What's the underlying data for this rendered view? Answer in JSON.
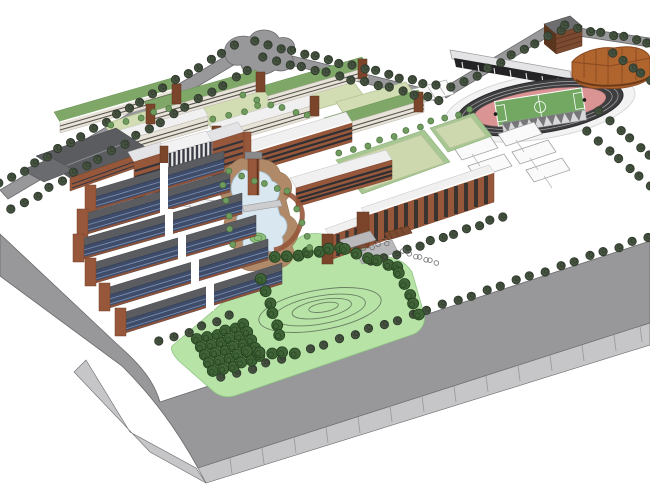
{
  "meta": {
    "kind": "3d-campus-masterplan-render",
    "style": "sketchup-aerial-perspective",
    "canvas": {
      "width": 650,
      "height": 487
    }
  },
  "colors": {
    "background": "#ffffff",
    "road": "#98989b",
    "road_face": "#c6c6c8",
    "road_edge": "#6a6a6c",
    "park": "#b7e3a6",
    "contour": "#6b7f63",
    "court_khaki": "#ced8af",
    "court_border": "#a6c792",
    "field_green": "#72a862",
    "track_pink": "#db9494",
    "track_ring": "#3e3e40",
    "stand_dark": "#232325",
    "canopy": "#d9d9db",
    "brick": "#96573b",
    "brick_dark": "#7a452b",
    "roof_green": "#7fa868",
    "roof_dark": "#5b5c60",
    "window_blue": "#3e4c6a",
    "pond": "#d9e7f1",
    "pond_edge": "#9fb9cc",
    "island": "#8cc07c",
    "path_brown": "#b08a68",
    "gym_roof": "#b0642e",
    "slat_brown": "#7c4a30",
    "gray_bldg": "#b9b9bb",
    "tree_dark": "#45523f",
    "tree_park": "#3f6336",
    "tree_small": "#6f9c5e"
  },
  "scene": {
    "description": "Aerial perspective rendering of a university campus master plan on a white background: perimeter roads with street trees, northwest academic quads with green roofs, central library and pond with clock tower, southwest dormitory rows with blue window grids, east dormitory slabs, running track with soccer field and grandstand, gymnasium with orange hipped roof, sports courts, and a landscaped park with contoured hill and tree groves beside a wide segmented boulevard.",
    "areas": [
      "academic quads",
      "library plaza",
      "central pond",
      "clock tower",
      "west dormitory rows",
      "east dormitories",
      "running track stadium",
      "grandstand",
      "gymnasium",
      "basketball courts",
      "sports fields",
      "landscaped park",
      "tree grove",
      "perimeter roads",
      "main boulevard",
      "entrance plaza",
      "parking lot",
      "bike racks"
    ],
    "tree_rows": [
      {
        "name": "perimeter-trees-nw-outer",
        "type": "road",
        "x1": 0,
        "y1": 184,
        "x2": 234,
        "y2": 46,
        "n": 21
      },
      {
        "name": "perimeter-trees-nw-inner",
        "type": "road",
        "x1": 12,
        "y1": 210,
        "x2": 248,
        "y2": 70,
        "n": 20
      },
      {
        "name": "north-road-trees-outer",
        "type": "road",
        "x1": 256,
        "y1": 42,
        "x2": 436,
        "y2": 86,
        "n": 16
      },
      {
        "name": "north-road-trees-inner",
        "type": "road",
        "x1": 264,
        "y1": 58,
        "x2": 440,
        "y2": 100,
        "n": 15
      },
      {
        "name": "stadium-north-trees",
        "type": "road",
        "x1": 452,
        "y1": 88,
        "x2": 560,
        "y2": 30,
        "n": 10
      },
      {
        "name": "northeast-corner-trees",
        "type": "road",
        "x1": 566,
        "y1": 26,
        "x2": 648,
        "y2": 42,
        "n": 8
      },
      {
        "name": "east-boundary-trees",
        "type": "road",
        "x1": 614,
        "y1": 54,
        "x2": 650,
        "y2": 80,
        "n": 5
      },
      {
        "name": "stadium-east-trees-1",
        "type": "road",
        "x1": 600,
        "y1": 112,
        "x2": 650,
        "y2": 156,
        "n": 6
      },
      {
        "name": "stadium-east-trees-2",
        "type": "road",
        "x1": 588,
        "y1": 132,
        "x2": 650,
        "y2": 186,
        "n": 7
      },
      {
        "name": "main-road-trees",
        "type": "road",
        "x1": 222,
        "y1": 378,
        "x2": 648,
        "y2": 237,
        "n": 30
      },
      {
        "name": "park-west-edge-trees",
        "type": "road",
        "x1": 160,
        "y1": 342,
        "x2": 230,
        "y2": 316,
        "n": 6
      },
      {
        "name": "dorm-east-walkway-trees",
        "type": "road",
        "x1": 372,
        "y1": 262,
        "x2": 502,
        "y2": 217,
        "n": 12
      },
      {
        "name": "bike-racks-east",
        "type": "bike",
        "x1": 404,
        "y1": 252,
        "x2": 436,
        "y2": 263,
        "n": 7
      },
      {
        "name": "bike-racks-center",
        "type": "bike",
        "x1": 356,
        "y1": 250,
        "x2": 386,
        "y2": 243,
        "n": 5
      },
      {
        "name": "park-grove-row-1",
        "type": "park",
        "x1": 198,
        "y1": 340,
        "x2": 244,
        "y2": 325,
        "n": 6
      },
      {
        "name": "park-grove-row-2",
        "type": "park",
        "x1": 202,
        "y1": 348,
        "x2": 248,
        "y2": 333,
        "n": 6
      },
      {
        "name": "park-grove-row-3",
        "type": "park",
        "x1": 206,
        "y1": 356,
        "x2": 252,
        "y2": 341,
        "n": 6
      },
      {
        "name": "park-grove-row-4",
        "type": "park",
        "x1": 210,
        "y1": 364,
        "x2": 256,
        "y2": 349,
        "n": 6
      },
      {
        "name": "park-grove-row-5",
        "type": "park",
        "x1": 214,
        "y1": 372,
        "x2": 260,
        "y2": 357,
        "n": 6
      },
      {
        "name": "park-hill-west-trees",
        "type": "park",
        "x1": 262,
        "y1": 280,
        "x2": 280,
        "y2": 336,
        "n": 6
      },
      {
        "name": "park-hill-north-trees-1",
        "type": "park",
        "x1": 276,
        "y1": 258,
        "x2": 340,
        "y2": 248,
        "n": 7
      },
      {
        "name": "park-hill-north-trees-2",
        "type": "park",
        "x1": 346,
        "y1": 250,
        "x2": 398,
        "y2": 268,
        "n": 6
      },
      {
        "name": "park-hill-east-trees",
        "type": "park",
        "x1": 400,
        "y1": 274,
        "x2": 418,
        "y2": 314,
        "n": 5
      },
      {
        "name": "park-south-trees",
        "type": "park",
        "x1": 248,
        "y1": 352,
        "x2": 294,
        "y2": 353,
        "n": 5
      },
      {
        "name": "courtyard-trees-1",
        "type": "small",
        "x1": 112,
        "y1": 126,
        "x2": 168,
        "y2": 108,
        "n": 5
      },
      {
        "name": "courtyard-trees-2",
        "type": "small",
        "x1": 244,
        "y1": 96,
        "x2": 308,
        "y2": 116,
        "n": 6
      },
      {
        "name": "courtyard-trees-3",
        "type": "small",
        "x1": 214,
        "y1": 120,
        "x2": 258,
        "y2": 106,
        "n": 4
      },
      {
        "name": "plaza-trees-south",
        "type": "small",
        "x1": 230,
        "y1": 172,
        "x2": 288,
        "y2": 192,
        "n": 6
      },
      {
        "name": "pond-west-trees",
        "type": "small",
        "x1": 224,
        "y1": 186,
        "x2": 232,
        "y2": 244,
        "n": 5
      },
      {
        "name": "pond-east-trees",
        "type": "small",
        "x1": 298,
        "y1": 210,
        "x2": 310,
        "y2": 248,
        "n": 4
      },
      {
        "name": "field-border-trees-1",
        "type": "small",
        "x1": 340,
        "y1": 154,
        "x2": 420,
        "y2": 127,
        "n": 7
      },
      {
        "name": "field-border-trees-2",
        "type": "small",
        "x1": 432,
        "y1": 122,
        "x2": 470,
        "y2": 110,
        "n": 4
      }
    ]
  }
}
